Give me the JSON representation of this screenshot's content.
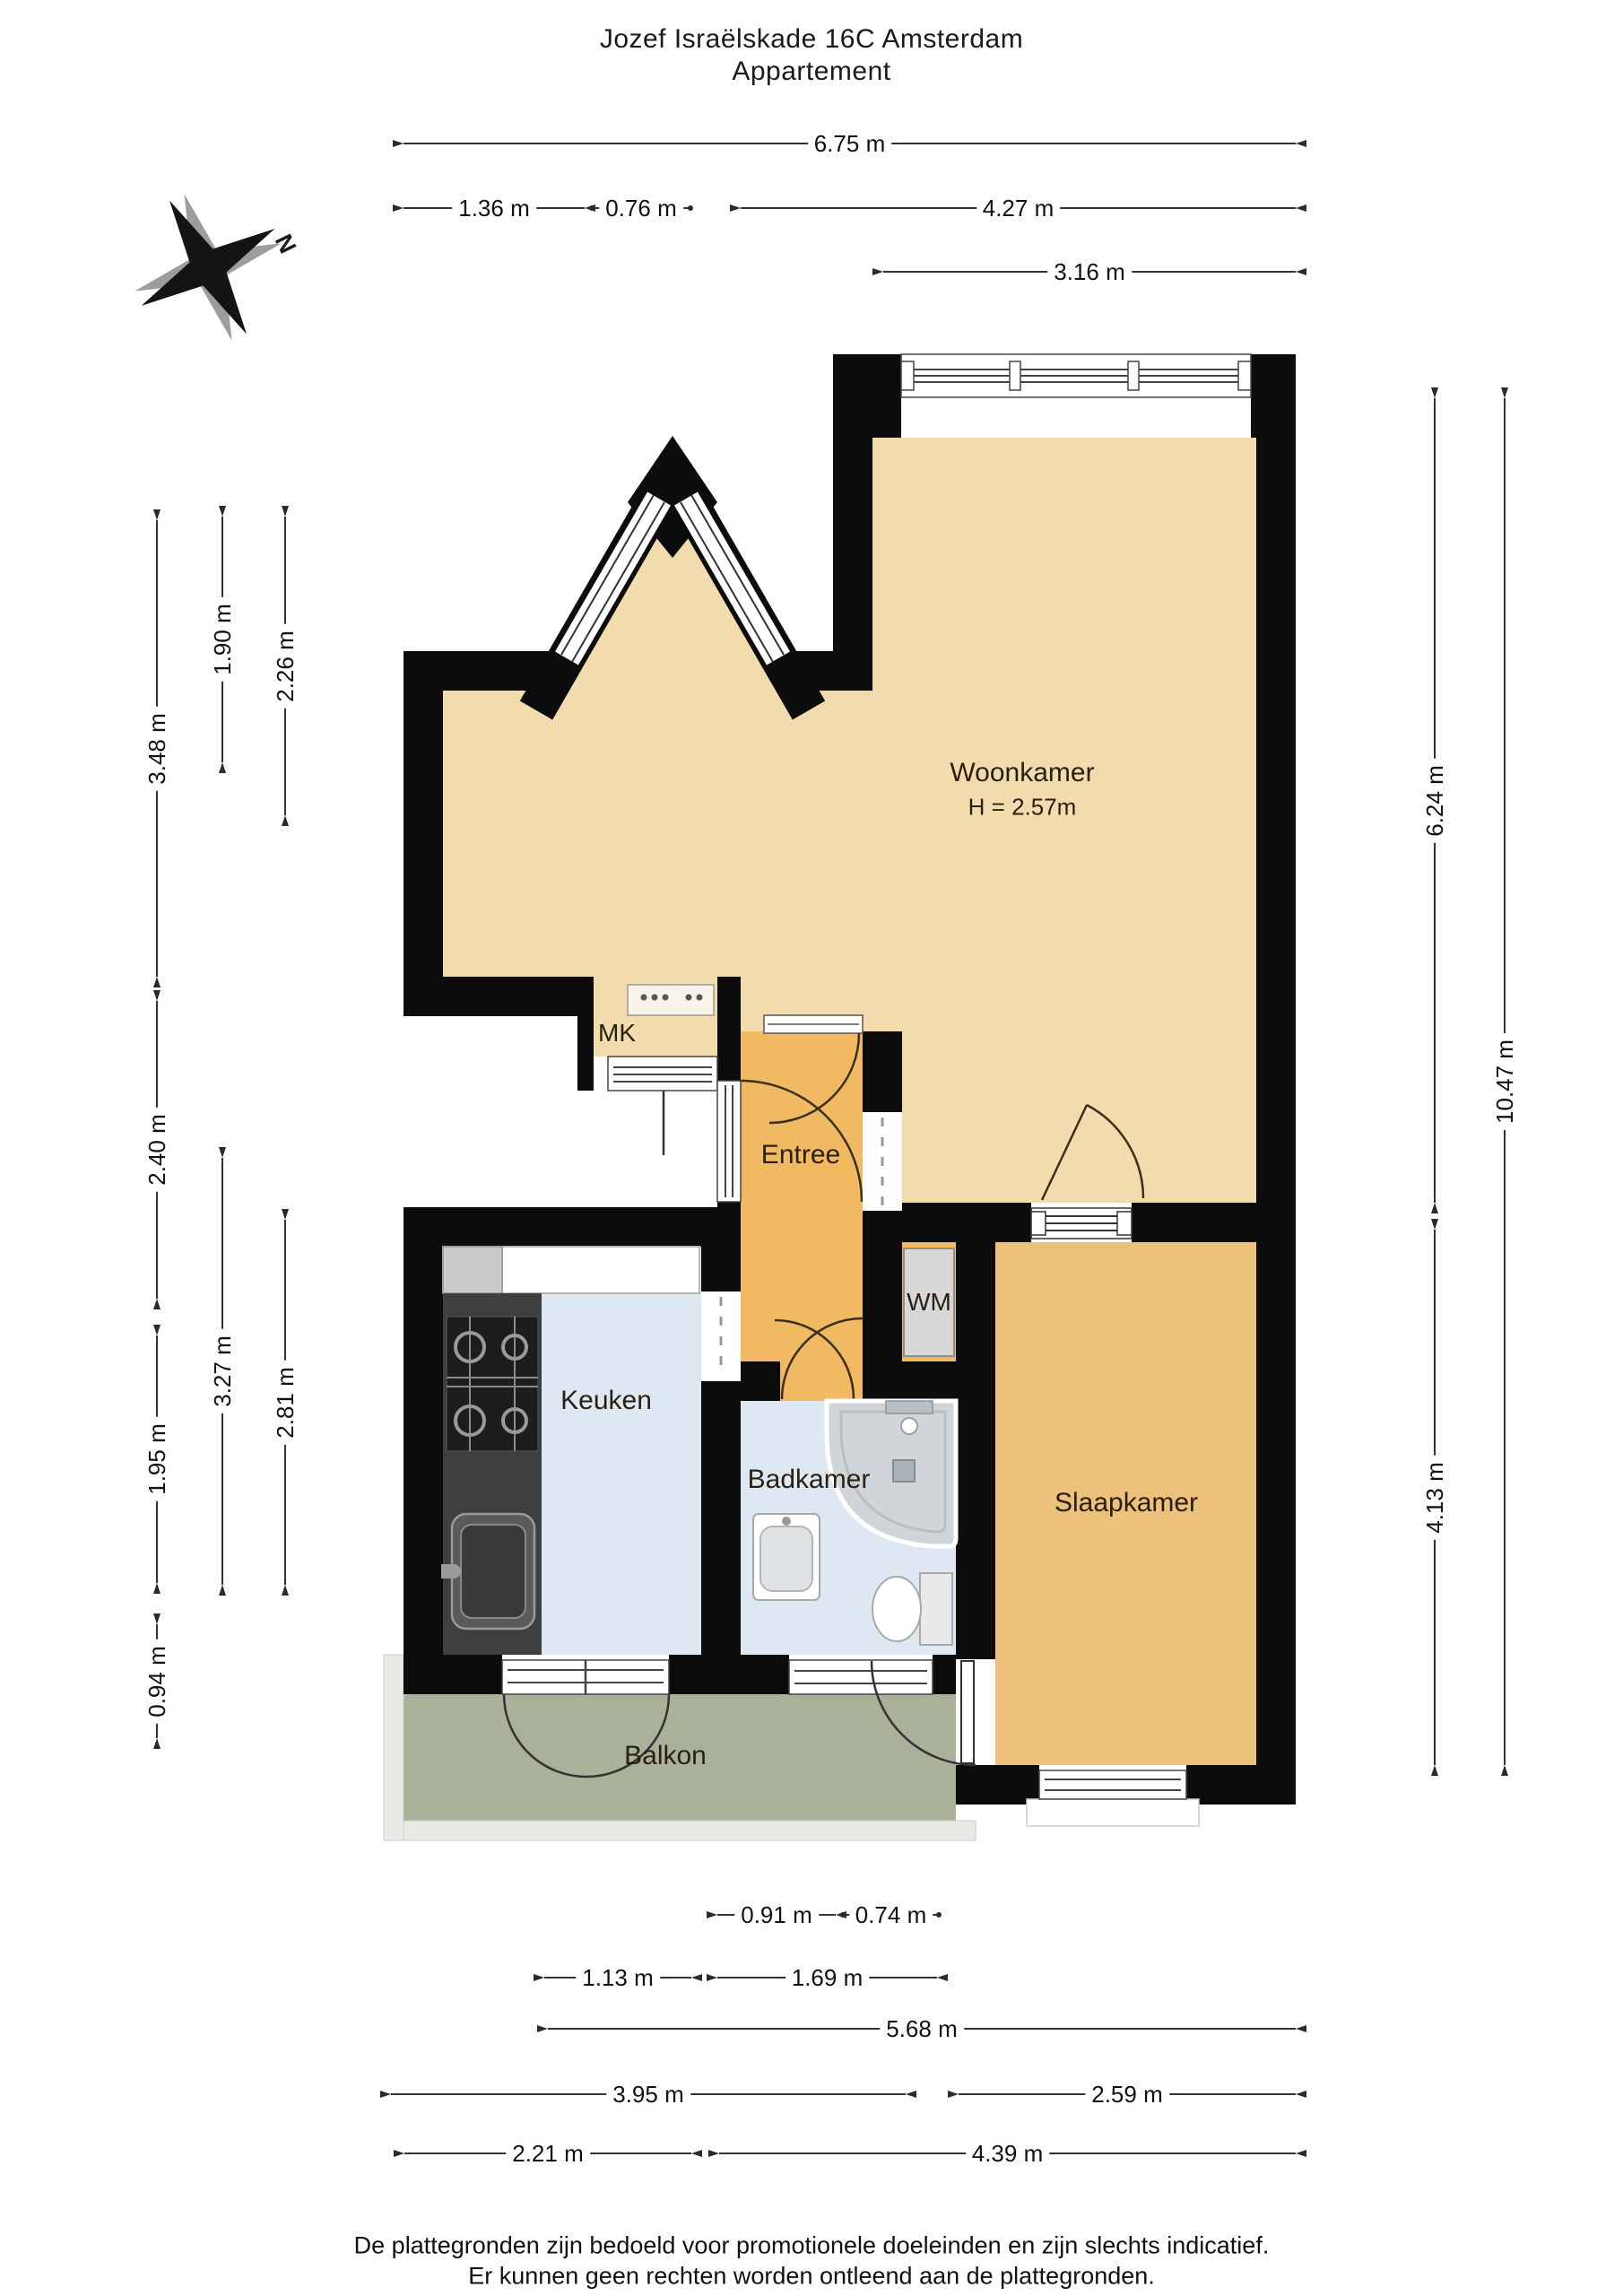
{
  "title": {
    "line1": "Jozef Israëlskade 16C Amsterdam",
    "line2": "Appartement"
  },
  "compass": {
    "label": "N"
  },
  "rooms": {
    "woonkamer": {
      "name": "Woonkamer",
      "ceiling_height": "H = 2.57m"
    },
    "entree": {
      "name": "Entree"
    },
    "keuken": {
      "name": "Keuken"
    },
    "badkamer": {
      "name": "Badkamer"
    },
    "slaapkamer": {
      "name": "Slaapkamer"
    },
    "balkon": {
      "name": "Balkon"
    },
    "wm": {
      "name": "WM"
    },
    "mk": {
      "name": "MK"
    }
  },
  "dimensions": {
    "top": [
      {
        "label": "6.75 m",
        "orient": "h",
        "at": 160,
        "from": 450,
        "to": 1445,
        "ends": "arrow"
      },
      {
        "label": "1.36 m",
        "orient": "h",
        "at": 232,
        "from": 450,
        "to": 652,
        "ends": "arrow"
      },
      {
        "label": "0.76 m",
        "orient": "h",
        "at": 232,
        "from": 660,
        "to": 770,
        "ends": "dot"
      },
      {
        "label": "4.27 m",
        "orient": "h",
        "at": 232,
        "from": 826,
        "to": 1445,
        "ends": "arrow"
      },
      {
        "label": "3.16 m",
        "orient": "h",
        "at": 303,
        "from": 985,
        "to": 1445,
        "ends": "arrow"
      }
    ],
    "left": [
      {
        "label": "3.48 m",
        "orient": "v",
        "at": 175,
        "from": 580,
        "to": 1089,
        "ends": "arrow"
      },
      {
        "label": "2.40 m",
        "orient": "v",
        "at": 175,
        "from": 1116,
        "to": 1448,
        "ends": "arrow"
      },
      {
        "label": "1.95 m",
        "orient": "v",
        "at": 175,
        "from": 1489,
        "to": 1765,
        "ends": "arrow"
      },
      {
        "label": "0.94 m",
        "orient": "v",
        "at": 175,
        "from": 1811,
        "to": 1938,
        "ends": "arrow"
      },
      {
        "label": "1.90 m",
        "orient": "v",
        "at": 248,
        "from": 576,
        "to": 850,
        "ends": "arrow"
      },
      {
        "label": "3.27 m",
        "orient": "v",
        "at": 248,
        "from": 1291,
        "to": 1767,
        "ends": "arrow"
      },
      {
        "label": "2.26 m",
        "orient": "v",
        "at": 318,
        "from": 576,
        "to": 909,
        "ends": "arrow"
      },
      {
        "label": "2.81 m",
        "orient": "v",
        "at": 318,
        "from": 1360,
        "to": 1767,
        "ends": "arrow"
      }
    ],
    "right": [
      {
        "label": "6.24 m",
        "orient": "v",
        "at": 1600,
        "from": 444,
        "to": 1341,
        "ends": "arrow"
      },
      {
        "label": "4.13 m",
        "orient": "v",
        "at": 1600,
        "from": 1371,
        "to": 1968,
        "ends": "arrow"
      },
      {
        "label": "10.47 m",
        "orient": "v",
        "at": 1678,
        "from": 444,
        "to": 1968,
        "ends": "arrow"
      }
    ],
    "bottom": [
      {
        "label": "0.91 m",
        "orient": "h",
        "at": 2135,
        "from": 800,
        "to": 932,
        "ends": "arrow"
      },
      {
        "label": "0.74 m",
        "orient": "h",
        "at": 2135,
        "from": 940,
        "to": 1047,
        "ends": "dot"
      },
      {
        "label": "1.13 m",
        "orient": "h",
        "at": 2205,
        "from": 607,
        "to": 771,
        "ends": "arrow"
      },
      {
        "label": "1.69 m",
        "orient": "h",
        "at": 2205,
        "from": 800,
        "to": 1045,
        "ends": "arrow"
      },
      {
        "label": "5.68 m",
        "orient": "h",
        "at": 2262,
        "from": 611,
        "to": 1445,
        "ends": "arrow"
      },
      {
        "label": "3.95 m",
        "orient": "h",
        "at": 2335,
        "from": 436,
        "to": 1010,
        "ends": "arrow"
      },
      {
        "label": "2.59 m",
        "orient": "h",
        "at": 2335,
        "from": 1069,
        "to": 1445,
        "ends": "arrow"
      },
      {
        "label": "2.21 m",
        "orient": "h",
        "at": 2401,
        "from": 451,
        "to": 771,
        "ends": "arrow"
      },
      {
        "label": "4.39 m",
        "orient": "h",
        "at": 2401,
        "from": 802,
        "to": 1445,
        "ends": "arrow"
      }
    ]
  },
  "footer": {
    "line1": "De plattegronden zijn bedoeld voor promotionele doeleinden en zijn slechts indicatief.",
    "line2": "Er kunnen geen rechten worden ontleend aan de plattegronden."
  },
  "colors": {
    "wall": "#0c0c0c",
    "woonkamer": "#f2dcae",
    "slaapkamer": "#ecc17c",
    "entree": "#f1b961",
    "wet_rooms": "#dde8f2",
    "balkon": "#a9b299",
    "balkon_rim": "#e9e9e5",
    "wm_closet": "#d8d8d8",
    "counter": "#3f3f3f",
    "dimension_lines": "#333333"
  }
}
